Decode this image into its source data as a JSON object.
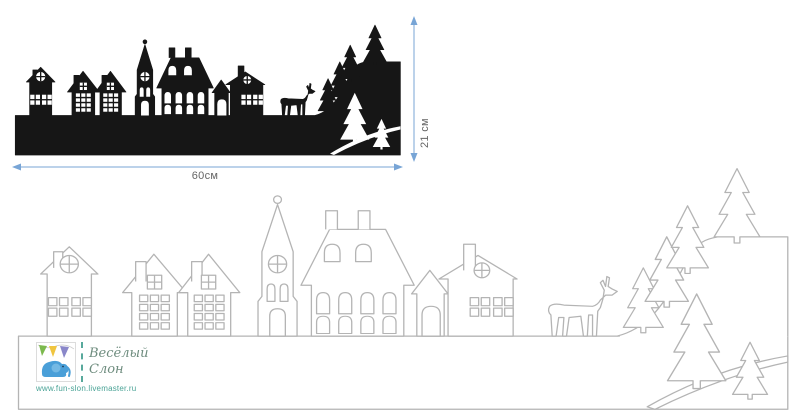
{
  "dimensions": {
    "width_label": "60см",
    "height_label": "21 см"
  },
  "logo": {
    "title_line1": "Весёлый",
    "title_line2": "Слон",
    "url": "www.fun-slon.livemaster.ru"
  },
  "colors": {
    "background": "#ffffff",
    "silhouette_fill": "#161616",
    "template_outline": "#b4b4b4",
    "dimension_arrow": "#78a5d6",
    "dimension_text": "#666666",
    "logo_title": "#6e8c7e",
    "logo_url": "#4aa396"
  },
  "scene": {
    "elements": [
      "ground-strip",
      "gabled-house",
      "row-house",
      "row-house",
      "church-tower",
      "manor-house",
      "double-gable-house",
      "deer",
      "fir-trees",
      "hillside",
      "foreground-mound"
    ]
  }
}
